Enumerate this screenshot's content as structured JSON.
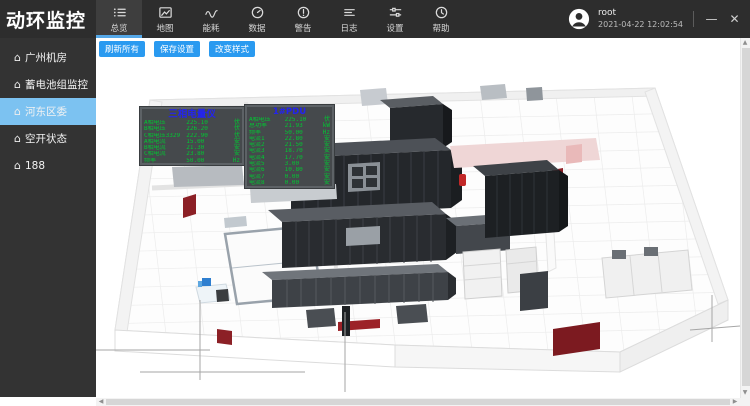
{
  "app": {
    "title": "动环监控"
  },
  "topnav": {
    "tabs": [
      {
        "label": "总览",
        "icon": "overview-list-icon",
        "name": "tab-overview",
        "active": true
      },
      {
        "label": "地图",
        "icon": "map-image-icon",
        "name": "tab-map"
      },
      {
        "label": "能耗",
        "icon": "energy-wave-icon",
        "name": "tab-energy"
      },
      {
        "label": "数据",
        "icon": "data-gauge-icon",
        "name": "tab-data"
      },
      {
        "label": "警告",
        "icon": "alarm-icon",
        "name": "tab-alarm"
      },
      {
        "label": "日志",
        "icon": "log-icon",
        "name": "tab-log"
      },
      {
        "label": "设置",
        "icon": "settings-sliders-icon",
        "name": "tab-settings"
      },
      {
        "label": "帮助",
        "icon": "help-clock-icon",
        "name": "tab-help"
      }
    ]
  },
  "user": {
    "name": "root",
    "datetime": "2021-04-22 12:02:54"
  },
  "window_controls": {
    "minimize": "—",
    "close": "✕"
  },
  "sidebar": {
    "home_glyph": "⌂",
    "caret_glyph": "▸",
    "items": [
      {
        "label": "广州机房",
        "name": "sidebar-item-guangzhou-room",
        "expandable": true
      },
      {
        "label": "蓄电池组监控",
        "name": "sidebar-item-battery-group-monitor"
      },
      {
        "label": "河东区委",
        "name": "sidebar-item-hedong-district",
        "selected": true
      },
      {
        "label": "空开状态",
        "name": "sidebar-item-breaker-status"
      },
      {
        "label": "188",
        "name": "sidebar-item-188"
      }
    ]
  },
  "toolbar": {
    "buttons": [
      {
        "label": "刷新所有",
        "name": "refresh-all-button"
      },
      {
        "label": "保存设置",
        "name": "save-settings-button"
      },
      {
        "label": "改变样式",
        "name": "change-style-button"
      }
    ]
  },
  "monitor_panels": [
    {
      "title": "三相电量仪",
      "rows": [
        {
          "label": "A相电压",
          "value": "225.10",
          "unit": "伏"
        },
        {
          "label": "B相电压",
          "value": "226.20",
          "unit": "伏"
        },
        {
          "label": "C相电压3329",
          "value": "222.90",
          "unit": "伏"
        },
        {
          "label": "A相电流",
          "value": "15.00",
          "unit": "安"
        },
        {
          "label": "B相电流",
          "value": "21.30",
          "unit": "安"
        },
        {
          "label": "C相电流",
          "value": "23.80",
          "unit": "安"
        },
        {
          "label": "频率",
          "value": "50.00",
          "unit": "Hz"
        }
      ]
    },
    {
      "title": "1#PDU",
      "rows": [
        {
          "label": "A相电压",
          "value": "225.10",
          "unit": "伏"
        },
        {
          "label": "总功率",
          "value": "21.93",
          "unit": "kW"
        },
        {
          "label": "频率",
          "value": "50.00",
          "unit": "Hz"
        },
        {
          "label": "电流1",
          "value": "22.80",
          "unit": "安"
        },
        {
          "label": "电流2",
          "value": "21.50",
          "unit": "安"
        },
        {
          "label": "电流3",
          "value": "18.70",
          "unit": "安"
        },
        {
          "label": "电流4",
          "value": "17.70",
          "unit": "安"
        },
        {
          "label": "电流5",
          "value": "3.00",
          "unit": "安"
        },
        {
          "label": "电流6",
          "value": "10.80",
          "unit": "安"
        },
        {
          "label": "电流7",
          "value": "0.00",
          "unit": "安"
        },
        {
          "label": "电流8",
          "value": "0.00",
          "unit": "安"
        }
      ]
    }
  ],
  "colors": {
    "topbar_bg": "#2d2d2d",
    "active_tab_underline": "#55a8e8",
    "sidebar_selected_bg": "#7cc2f1",
    "button_bg": "#2a9af0",
    "panel_title_blue": "#2323f0",
    "panel_value_green": "#00c832",
    "red_accent": "#8c2026"
  }
}
